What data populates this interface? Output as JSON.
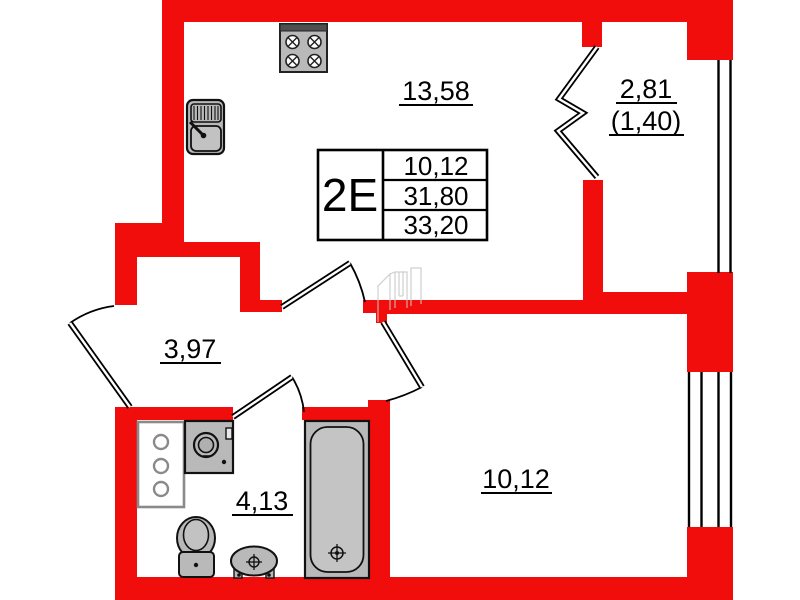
{
  "floor_plan": {
    "info_table": {
      "unit_label": "2E",
      "row1": "10,12",
      "row2": "31,80",
      "row3": "33,20"
    },
    "rooms": {
      "kitchen_living": {
        "label": "13,58"
      },
      "balcony": {
        "label": "2,81",
        "label_secondary": "(1,40)"
      },
      "hallway": {
        "label": "3,97"
      },
      "bathroom": {
        "label": "4,13"
      },
      "bedroom": {
        "label": "10,12"
      }
    },
    "colors": {
      "wall": "#f20d0d",
      "fixture_fill": "#b9b9b9",
      "line": "#000000"
    },
    "fixture_icons": [
      "stove-icon",
      "kitchen-sink-icon",
      "riser-cabinet-icon",
      "washing-machine-icon",
      "toilet-icon",
      "wash-basin-icon",
      "bathtub-icon"
    ]
  }
}
